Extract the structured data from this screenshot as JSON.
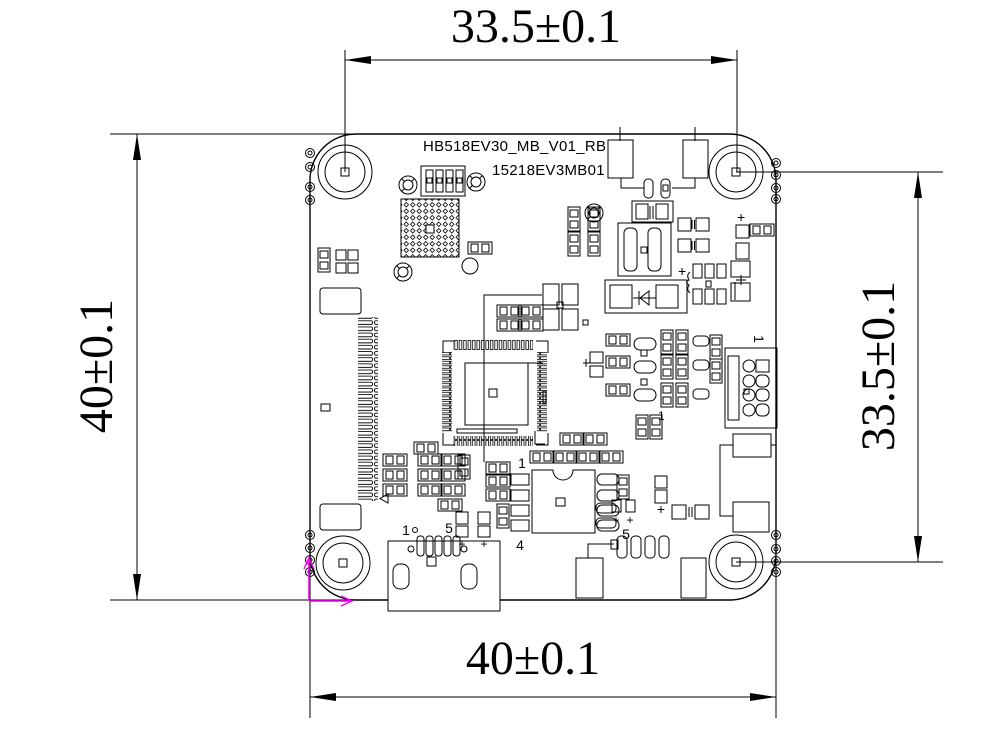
{
  "colors": {
    "background": "#ffffff",
    "line": "#000000",
    "origin_marker": "#ff00ff"
  },
  "board": {
    "title": "HB518EV30_MB_V01_RB",
    "part_number": "15218EV3MB01"
  },
  "dimensions": {
    "top": {
      "label": "33.5±0.1"
    },
    "bottom": {
      "label": "40±0.1"
    },
    "left": {
      "label": "40±0.1"
    },
    "right": {
      "label": "33.5±0.1"
    }
  },
  "labels": {
    "usb_pin_first": "1",
    "usb_pin_last": "5",
    "ic_pin_1": "1",
    "ic_pin_4": "4",
    "ic_pin_5": "5",
    "connector_pin_1": "1",
    "net_marker_1": "1",
    "pad_row_5": "5",
    "plus_mark": "+"
  }
}
